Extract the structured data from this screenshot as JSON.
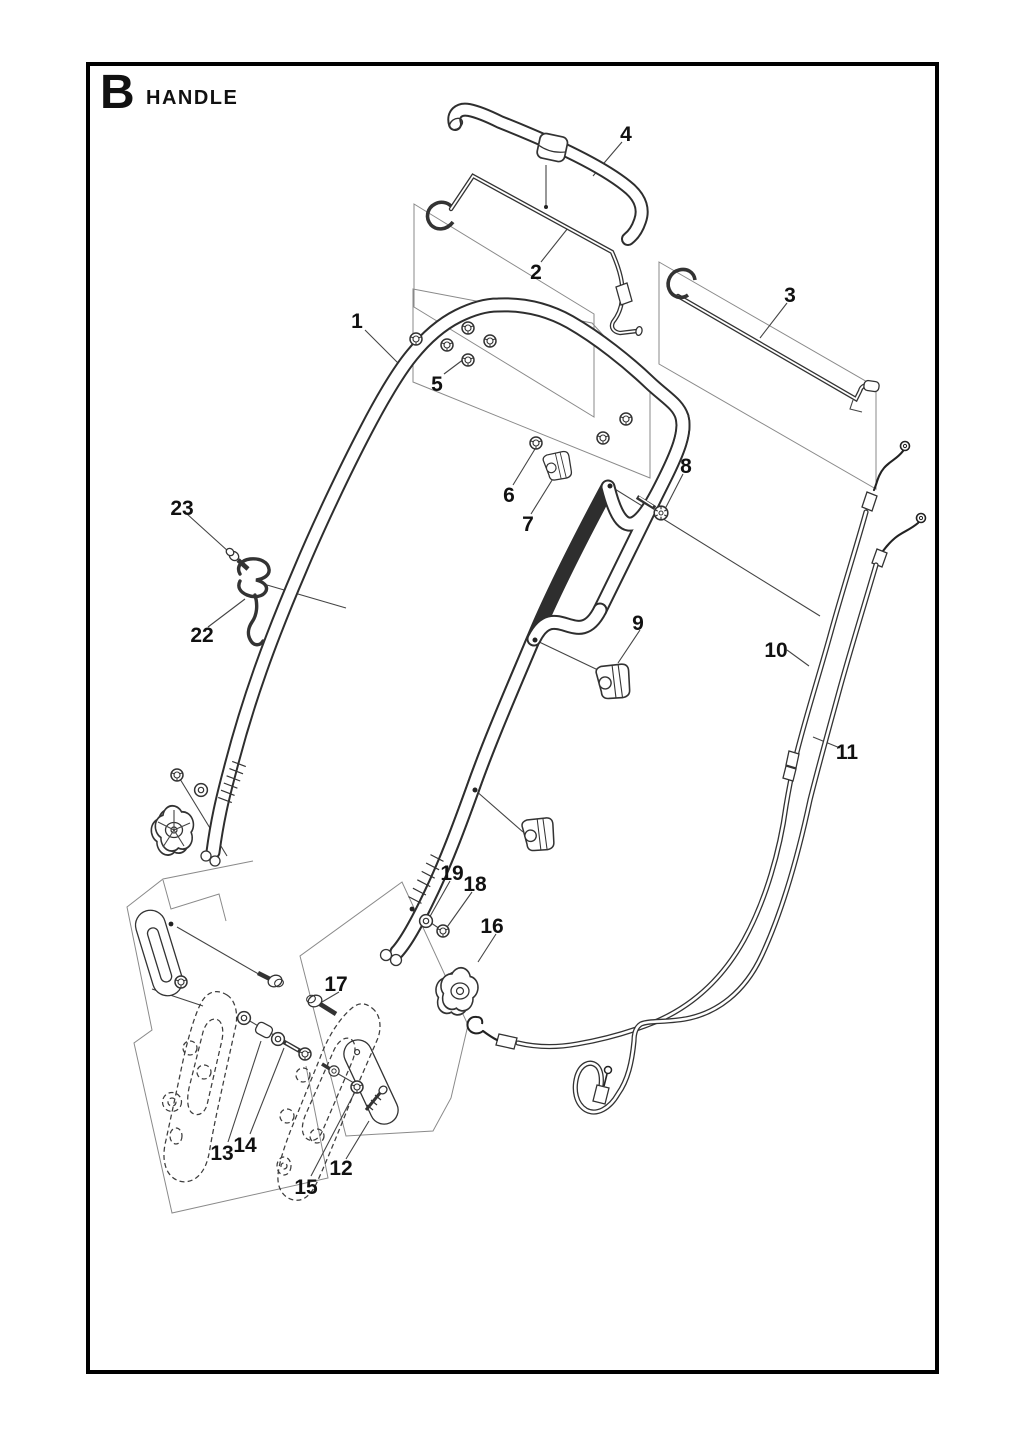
{
  "page": {
    "width": 1024,
    "height": 1435,
    "background": "#ffffff",
    "frame_color": "#000000"
  },
  "header": {
    "section_letter": "B",
    "section_title": "HANDLE"
  },
  "diagram": {
    "kind": "exploded-parts-diagram",
    "label_color": "#111111",
    "line_color": "#333333",
    "part_labels": [
      {
        "n": "1",
        "x": 357,
        "y": 328
      },
      {
        "n": "2",
        "x": 536,
        "y": 279
      },
      {
        "n": "3",
        "x": 790,
        "y": 302
      },
      {
        "n": "4",
        "x": 626,
        "y": 141
      },
      {
        "n": "5",
        "x": 437,
        "y": 391
      },
      {
        "n": "6",
        "x": 509,
        "y": 502
      },
      {
        "n": "7",
        "x": 528,
        "y": 531
      },
      {
        "n": "8",
        "x": 686,
        "y": 473
      },
      {
        "n": "9",
        "x": 638,
        "y": 630
      },
      {
        "n": "10",
        "x": 776,
        "y": 657
      },
      {
        "n": "11",
        "x": 847,
        "y": 759
      },
      {
        "n": "12",
        "x": 341,
        "y": 1175
      },
      {
        "n": "13",
        "x": 222,
        "y": 1160
      },
      {
        "n": "14",
        "x": 245,
        "y": 1152
      },
      {
        "n": "15",
        "x": 306,
        "y": 1194
      },
      {
        "n": "16",
        "x": 492,
        "y": 933
      },
      {
        "n": "17",
        "x": 336,
        "y": 991
      },
      {
        "n": "18",
        "x": 475,
        "y": 891
      },
      {
        "n": "19",
        "x": 452,
        "y": 880
      },
      {
        "n": "22",
        "x": 202,
        "y": 642
      },
      {
        "n": "23",
        "x": 182,
        "y": 515
      }
    ]
  }
}
